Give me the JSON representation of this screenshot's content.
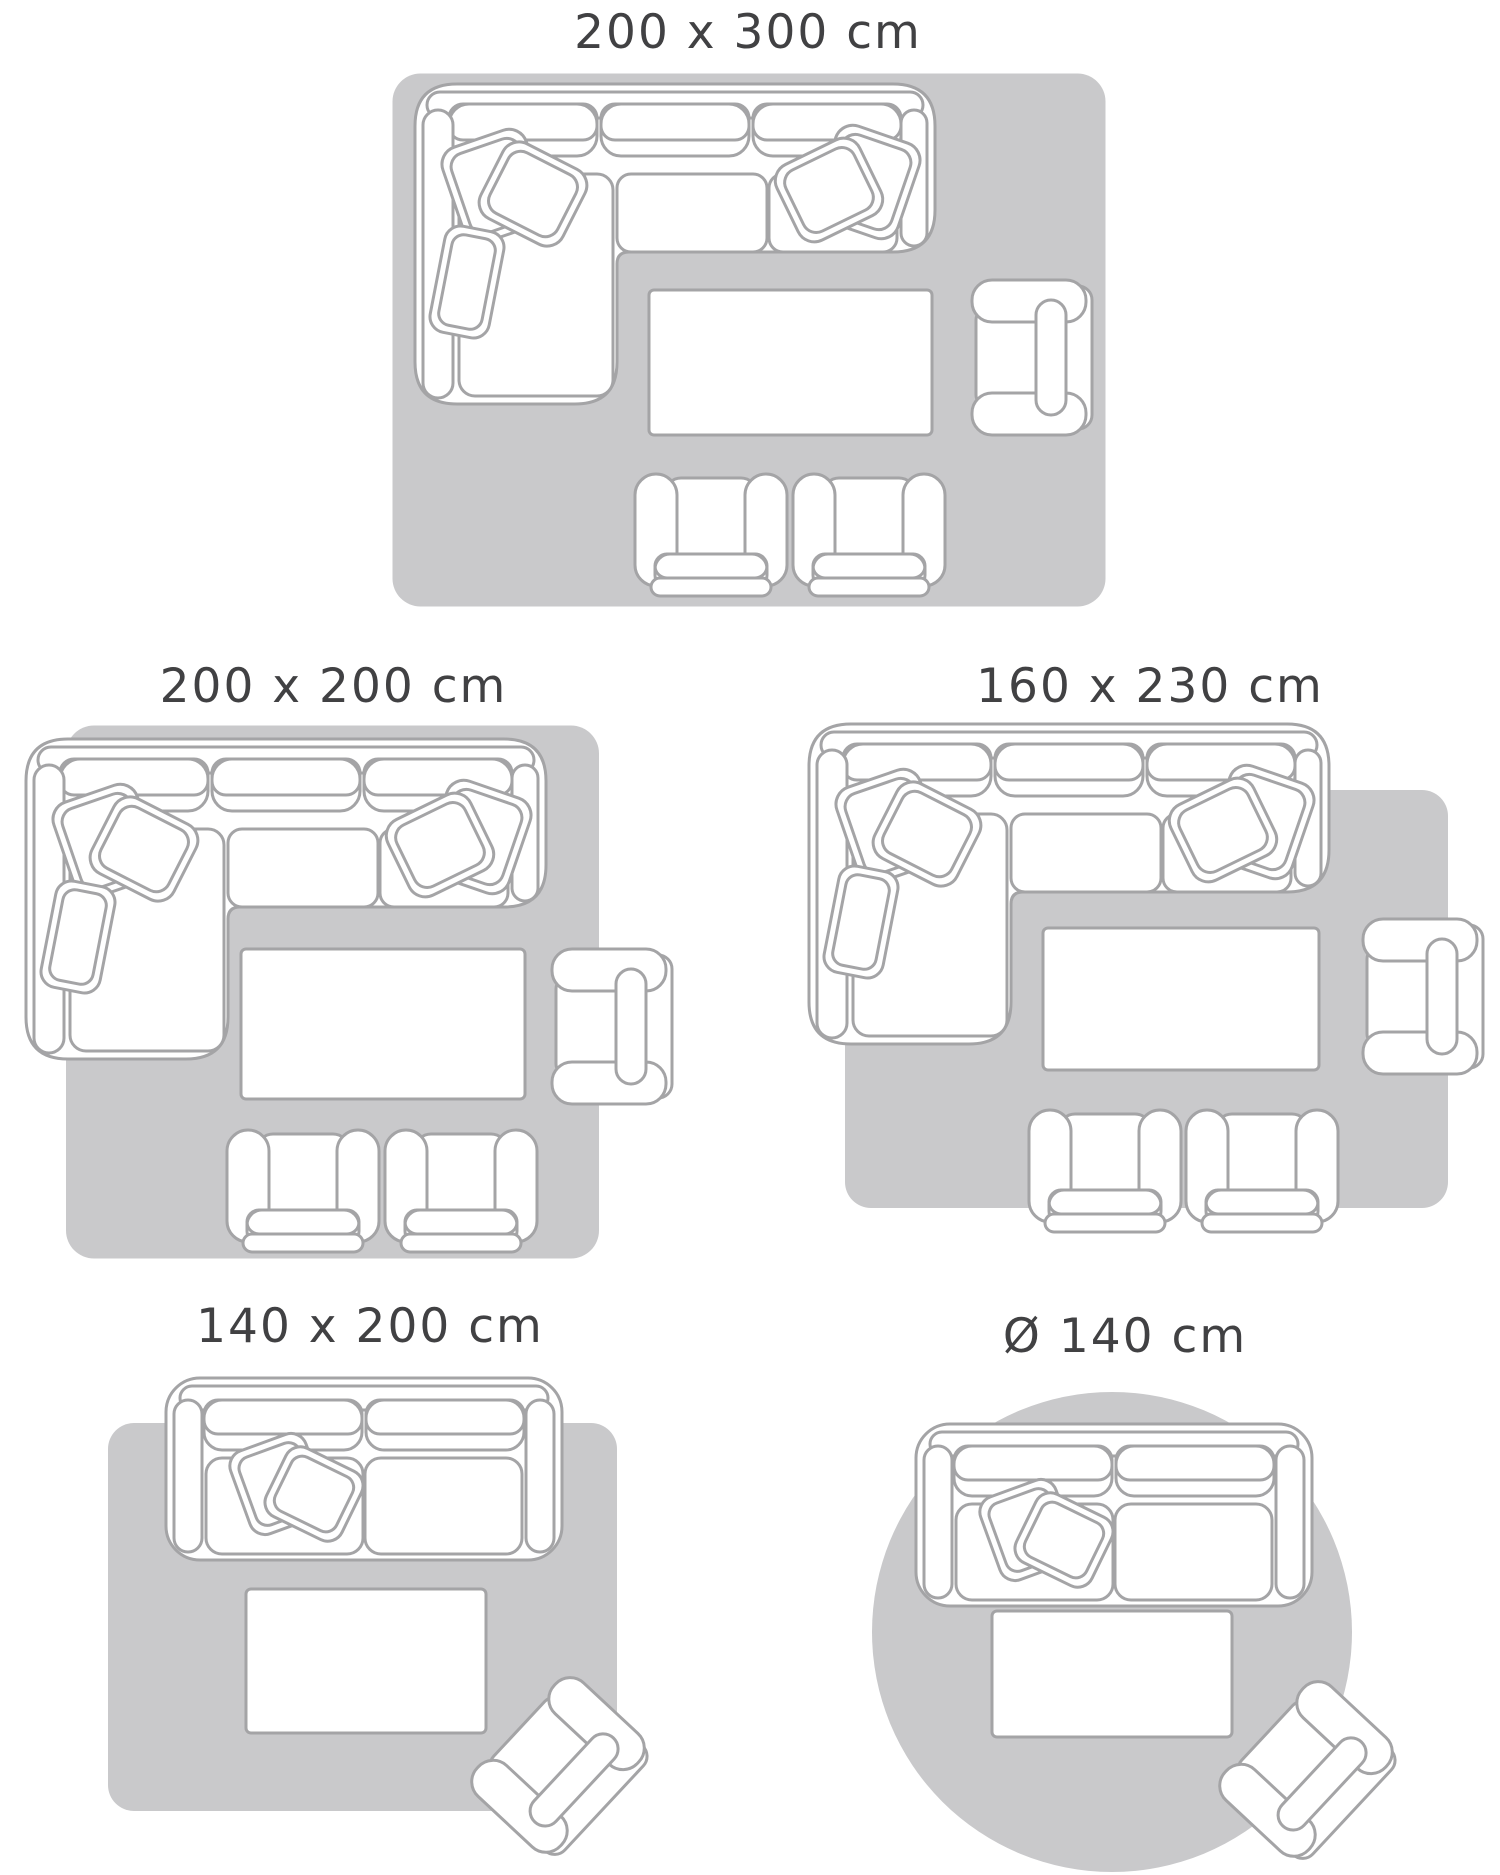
{
  "colors": {
    "rug_fill": "#c9c9cb",
    "furniture_outline": "#a4a4a6",
    "furniture_fill": "#ffffff",
    "label_text": "#414143",
    "background": "#ffffff"
  },
  "diagrams": [
    {
      "label": "200 x 300 cm",
      "rug_shape": "rectangle",
      "furniture": [
        "corner-sofa-with-cushions",
        "coffee-table",
        "armchair",
        "footstool-chair",
        "footstool-chair"
      ]
    },
    {
      "label": "200 x 200 cm",
      "rug_shape": "square",
      "furniture": [
        "corner-sofa-with-cushions",
        "coffee-table",
        "armchair",
        "footstool-chair",
        "footstool-chair"
      ]
    },
    {
      "label": "160 x 230 cm",
      "rug_shape": "rectangle",
      "furniture": [
        "corner-sofa-with-cushions",
        "coffee-table",
        "armchair",
        "footstool-chair",
        "footstool-chair"
      ]
    },
    {
      "label": "140 x 200 cm",
      "rug_shape": "rectangle",
      "furniture": [
        "two-seat-sofa-with-cushions",
        "coffee-table",
        "angled-armchair"
      ]
    },
    {
      "label": "Ø 140 cm",
      "rug_shape": "circle",
      "furniture": [
        "two-seat-sofa-with-cushions",
        "coffee-table",
        "angled-armchair"
      ]
    }
  ]
}
